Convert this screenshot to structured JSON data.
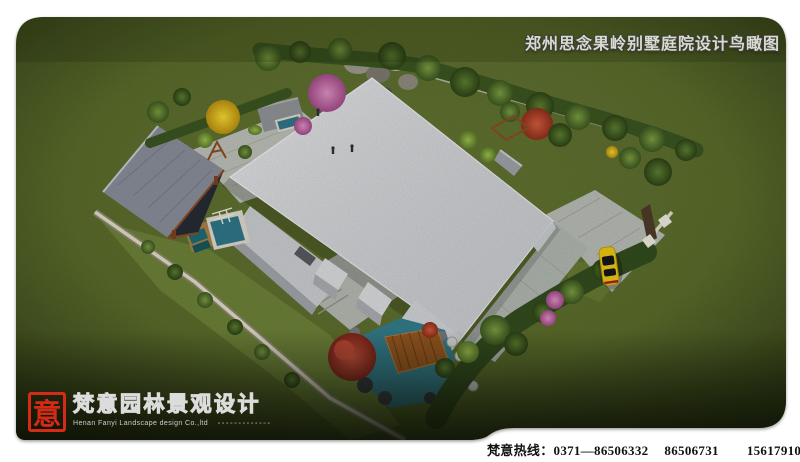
{
  "title": {
    "text": "郑州思念果岭别墅庭院设计鸟瞰图"
  },
  "logo": {
    "seal_char": "意",
    "company_cn": "梵意园林景观设计",
    "company_en": "Henan Fanyi Landscape design Co.,ltd",
    "decor_dots": "▫▫▫▫▫▫▫▫▫▫▫▫▫"
  },
  "footer": {
    "hotline_label": "梵意热线：",
    "phone_1": "0371—86506332",
    "phone_2": "86506731",
    "phone_3": "15617910900（孙）"
  },
  "scene": {
    "name": "villa-courtyard-birdseye-rendering",
    "colors": {
      "canvas": "#ffffff",
      "grass": "#57682a",
      "lawn_light": "#6d8238",
      "hedge": "#3a5320",
      "roof": "#d3d5d8",
      "roof_wall": "#a7aaae",
      "paving": "#b7bbb2",
      "water": "#2f7486",
      "pond": "#337a88",
      "deck_wood": "#95561f",
      "pavilion_roof": "#878b96",
      "wood_beam": "#8a4a24",
      "wall_stone": "#ddd8c2",
      "car_yellow": "#e6c412",
      "seal_red": "#d42a16",
      "title_text": "#d9dad2",
      "footer_text": "#121212"
    }
  }
}
